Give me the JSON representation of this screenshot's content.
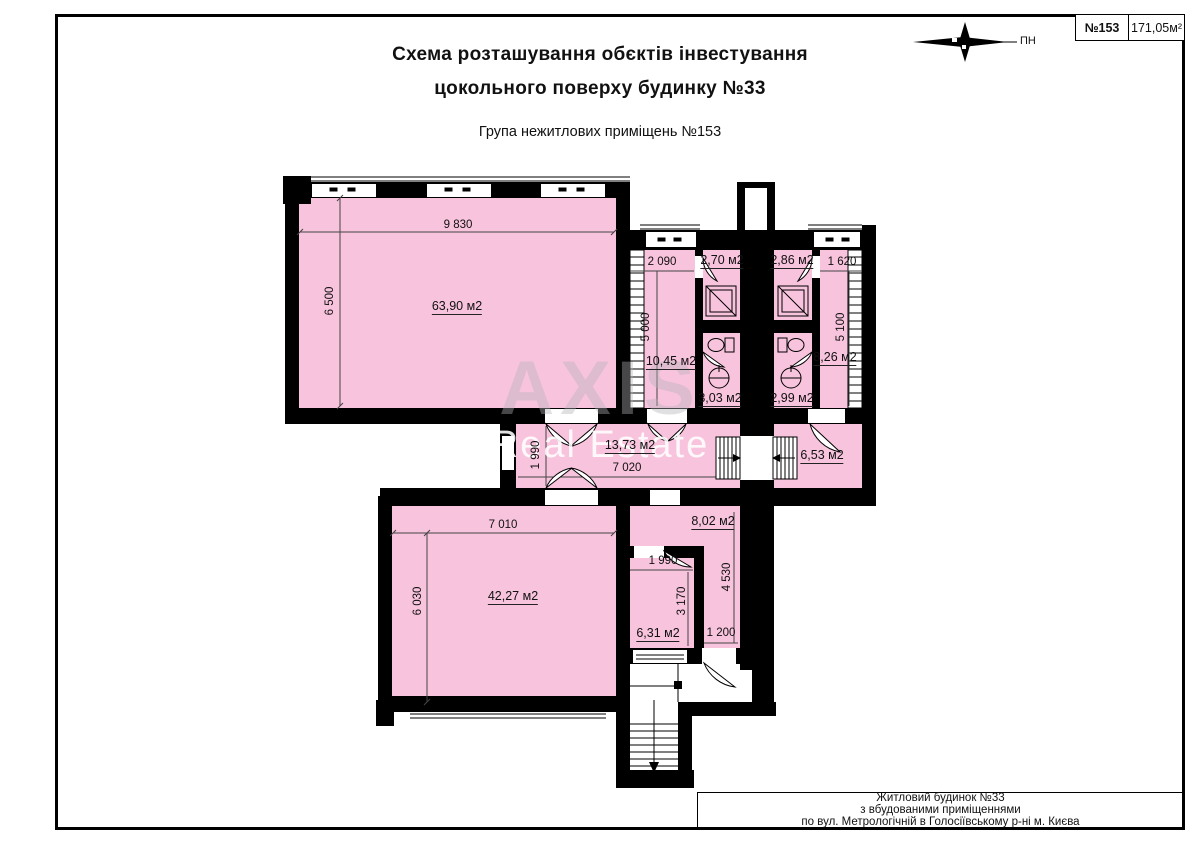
{
  "header": {
    "title_line1": "Схема розташування обєктів інвестування",
    "title_line2": "цокольного поверху будинку №33",
    "subtitle": "Група нежитлових приміщень №153"
  },
  "compass": {
    "label": "ПН"
  },
  "stamp": {
    "number": "№153",
    "area": "171,05м²"
  },
  "footer": {
    "line1": "Житловий будинок  №33",
    "line2": "з вбудованими приміщеннями",
    "line3": "по вул. Метрологічній в Голосіївському р-ні м. Києва"
  },
  "watermark": {
    "line1": "AXIS",
    "line2": "Real Estate"
  },
  "colors": {
    "room_fill": "#f8c3dd",
    "wall": "#000000",
    "dim_line": "#444444"
  },
  "plan": {
    "room_labels": [
      {
        "id": "room-63-90",
        "text": "63,90 м2"
      },
      {
        "id": "room-10-45",
        "text": "10,45 м2"
      },
      {
        "id": "room-2-70",
        "text": "2,70 м2"
      },
      {
        "id": "room-3-03",
        "text": "3,03 м2"
      },
      {
        "id": "room-2-86",
        "text": "2,86 м2"
      },
      {
        "id": "room-2-99",
        "text": "2,99 м2"
      },
      {
        "id": "room-8-26",
        "text": "8,26 м2"
      },
      {
        "id": "room-13-73",
        "text": "13,73 м2"
      },
      {
        "id": "room-6-53",
        "text": "6,53 м2"
      },
      {
        "id": "room-42-27",
        "text": "42,27 м2"
      },
      {
        "id": "room-6-31",
        "text": "6,31 м2"
      },
      {
        "id": "room-8-02",
        "text": "8,02 м2"
      }
    ],
    "dimension_labels": [
      {
        "id": "dim-9830",
        "text": "9 830"
      },
      {
        "id": "dim-6500",
        "text": "6 500"
      },
      {
        "id": "dim-2090",
        "text": "2 090"
      },
      {
        "id": "dim-5000",
        "text": "5 000"
      },
      {
        "id": "dim-1620",
        "text": "1 620"
      },
      {
        "id": "dim-5100",
        "text": "5 100"
      },
      {
        "id": "dim-1990-corridor",
        "text": "1 990"
      },
      {
        "id": "dim-7020",
        "text": "7 020"
      },
      {
        "id": "dim-7010",
        "text": "7 010"
      },
      {
        "id": "dim-6030",
        "text": "6 030"
      },
      {
        "id": "dim-1990-small",
        "text": "1 990"
      },
      {
        "id": "dim-3170",
        "text": "3 170"
      },
      {
        "id": "dim-1200",
        "text": "1 200"
      },
      {
        "id": "dim-4530",
        "text": "4 530"
      }
    ]
  }
}
